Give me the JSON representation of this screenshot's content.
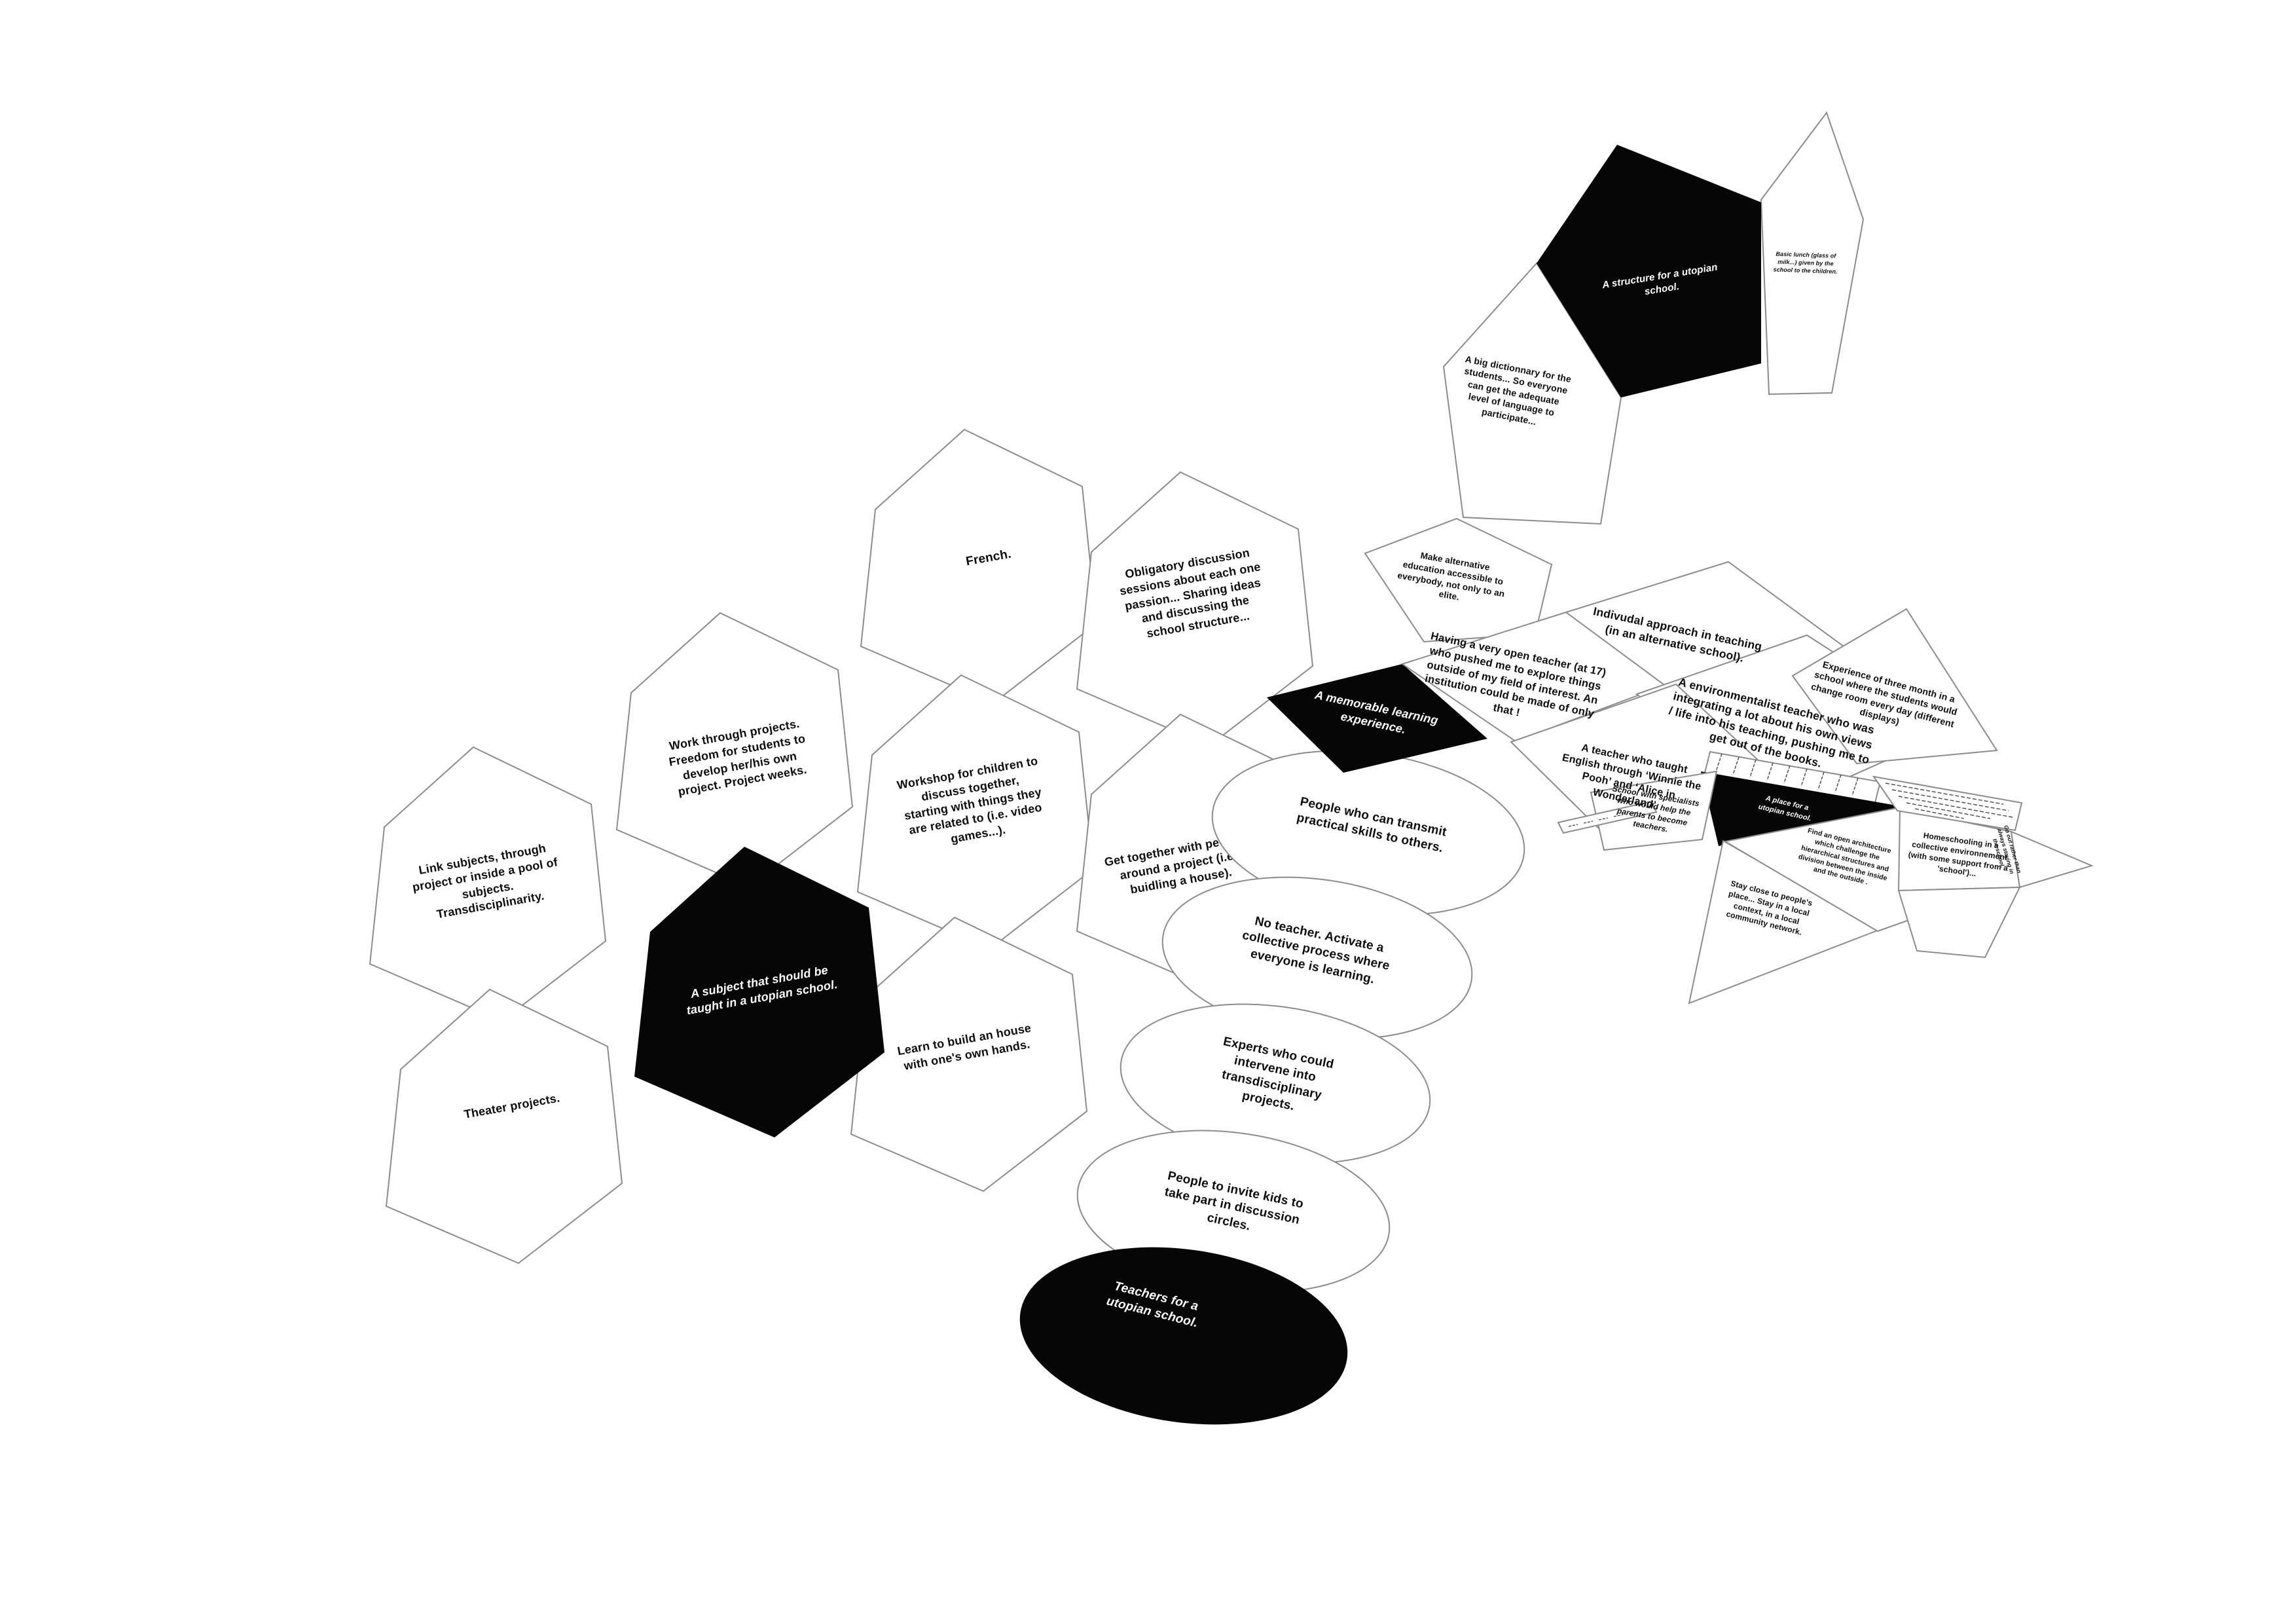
{
  "diagram": {
    "hexes": {
      "link_subjects": "Link subjects, through project or inside a pool of subjects. Transdisciplinarity.",
      "theater": "Theater projects.",
      "work_through": "Work through projects. Freedom for students to develop her/his own project. Project weeks.",
      "subject_black": "A subject that should be taught in a utopian school.",
      "french": "French.",
      "workshop": "Workshop for children to discuss together, starting with things they are related to (i.e. video games...).",
      "learn_build": "Learn to build an house with one's own hands.",
      "obligatory": "Obligatory discussion sessions about each one passion... Sharing ideas and discussing the school structure...",
      "get_together": "Get together with people, around a project (i.e. buidling a house)."
    },
    "ellipses": {
      "transmit": "People who can transmit practical skills to others.",
      "no_teacher": "No teacher. Activate a collective process where everyone is learning.",
      "experts": "Experts who could intervene into transdisciplinary projects.",
      "invite_kids": "People to invite kids to take part in discussion circles.",
      "teachers_black": "Teachers for a utopian school."
    },
    "pentagons": {
      "structure_black": "A structure for a utopian school.",
      "basic_lunch": "Basic lunch (glass of milk...) given by the school to the children.",
      "dictionnary": "A big dictionnary for the students... So everyone can get the adequate level of language to participate...",
      "alternative": "Make alternative education accessible to everybody, not only to an elite."
    },
    "panels": {
      "memorable_black": "A memorable learning experience.",
      "open_teacher": "Having a very open teacher (at 17) who pushed me to explore things outside of my field of interest. An institution could be made of only that !",
      "individual": "Indivudal approach in teaching (in an alternative school).",
      "environmentalist": "A environmentalist teacher who was integrating a lot about his own views / life into his teaching, pushing me to get out of the books.",
      "english_teacher": "A teacher who taught English through ‘Winnie the Pooh’ and ‘Alice in Wonderland’.",
      "three_month": "Experience of three month in a school where the students would change room every day (different displays)",
      "place_black": "A place for a utopian school.",
      "specialists": "School with specialists who would help the parents to become teachers.",
      "stay_close": "Stay close to people's place... Stay in a local context, in a local community network.",
      "open_architecture": "Find an open architecture which challenge the hierarchical structures and division between the inside and the outside .",
      "homeschooling": "Homeschooling in a collective environnement (with some support from a 'school')...",
      "go_out": "Go out rather than always staying in the school."
    }
  },
  "colors": {
    "card_black": "#060606",
    "card_white": "#ffffff",
    "stroke_gray": "#8c8c8c",
    "text": "#0d0d0d"
  }
}
